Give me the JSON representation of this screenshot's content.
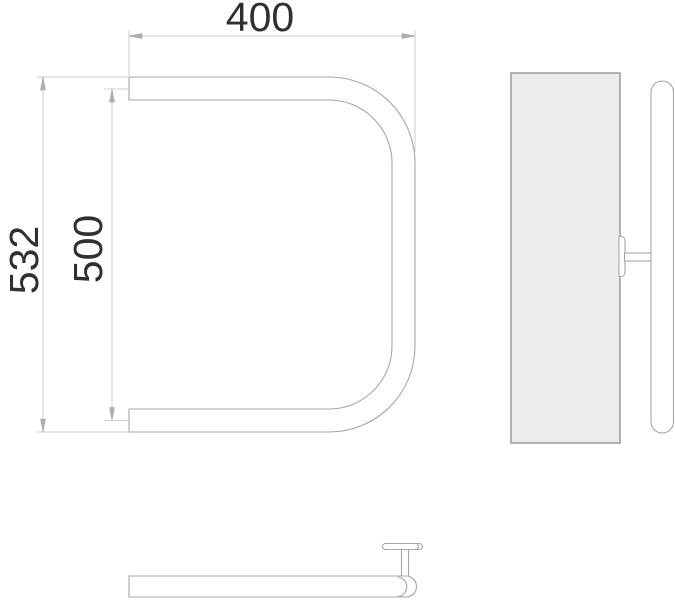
{
  "drawing": {
    "dimensions": {
      "width": {
        "label": "400"
      },
      "rail_pitch": {
        "label": "500"
      },
      "overall_height": {
        "label": "532"
      }
    },
    "colors": {
      "background": "#ffffff",
      "outline": "#a6a6a6",
      "dim_line": "#cdcdcd",
      "arrow": "#b0b0b0",
      "text": "#303030",
      "plate_fill": "#ececec",
      "plate_border": "#9a9a9a"
    }
  }
}
